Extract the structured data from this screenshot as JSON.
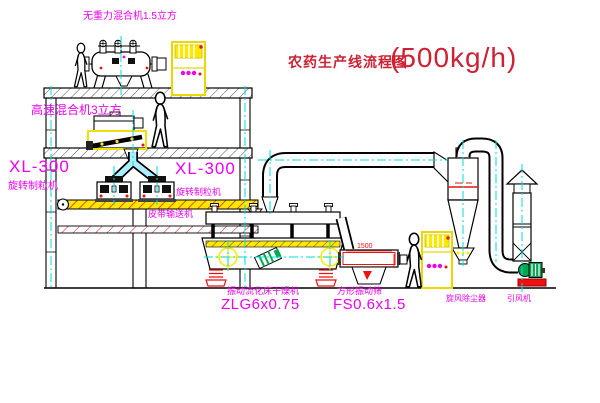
{
  "title": {
    "name": "农药生产线流程图",
    "capacity": "(500kg/h)"
  },
  "labels": {
    "gravity_mixer": "无重力混合机1.5立方",
    "high_speed_mixer": "高速混合机3立方",
    "granulator_left_model": "XL-300",
    "granulator_left_name": "旋转制粒机",
    "granulator_right_model": "XL-300",
    "granulator_right_name": "旋转制粒机",
    "belt_conveyor": "皮带输送机",
    "dryer_name": "振动流化床干燥机",
    "dryer_model": "ZLG6x0.75",
    "sieve_name": "方形振动筛",
    "sieve_model": "FS0.6x1.5",
    "sieve_dimension": "1500",
    "cyclone": "旋风除尘器",
    "fan": "引风机"
  },
  "colors": {
    "background": "#ffffff",
    "line_black": "#000000",
    "label_magenta": "#ee00ee",
    "title_red": "#cc2233",
    "dimension_red": "#ee1111",
    "centerline_cyan": "#00dcdc",
    "highlight_yellow": "#ffe800",
    "fan_green": "#00a550"
  }
}
